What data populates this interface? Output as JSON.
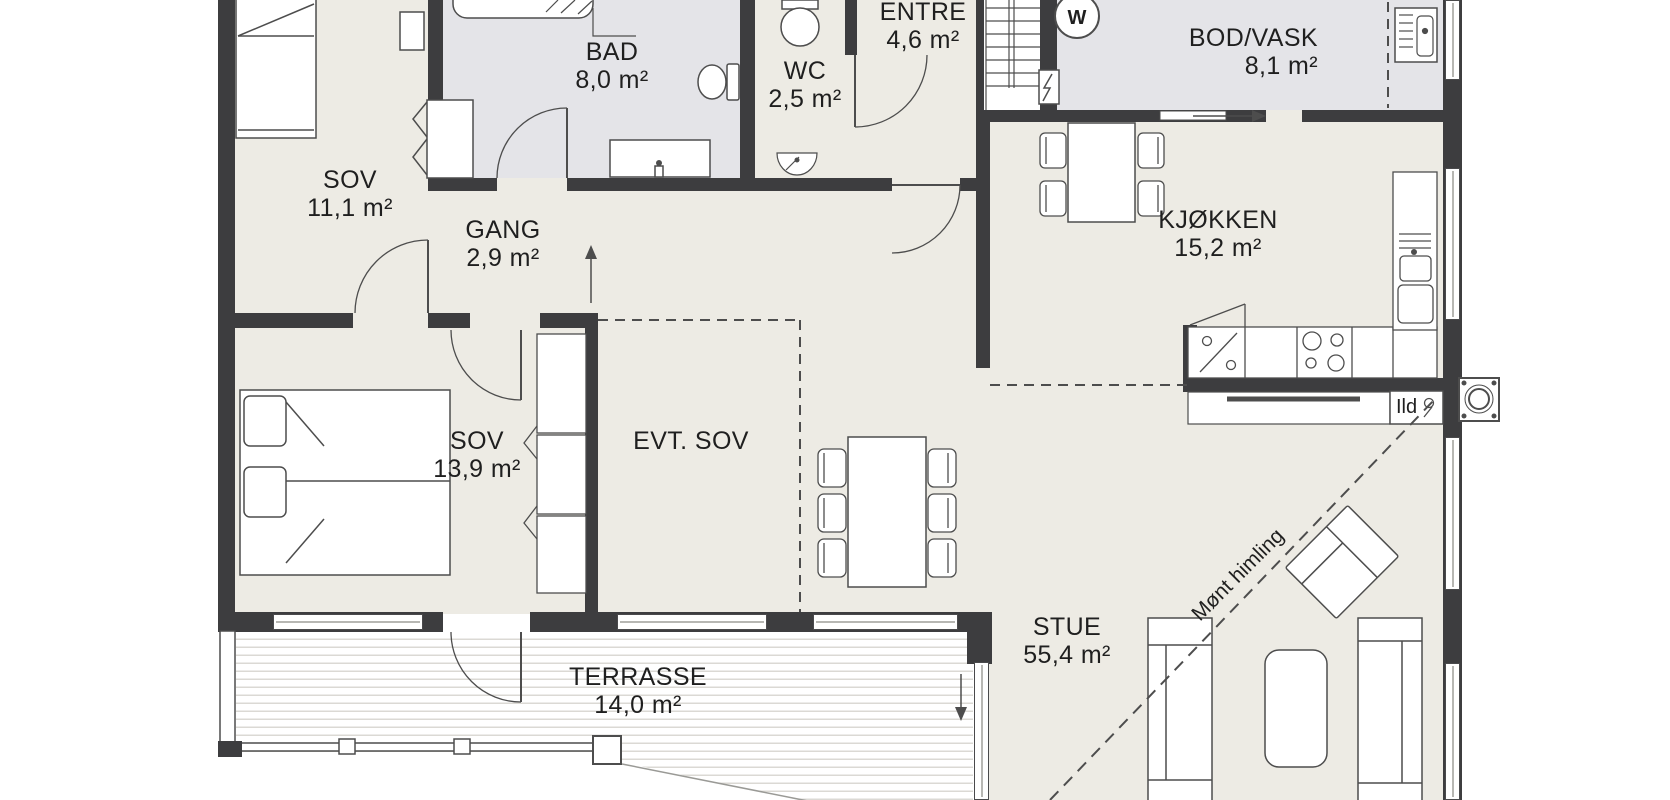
{
  "plan": {
    "type": "floor-plan",
    "rooms": {
      "sov1": {
        "name": "SOV",
        "area": "11,1 m²"
      },
      "bad": {
        "name": "BAD",
        "area": "8,0 m²"
      },
      "wc": {
        "name": "WC",
        "area": "2,5 m²"
      },
      "entre": {
        "name": "ENTRE",
        "area": "4,6 m²"
      },
      "bod": {
        "name": "BOD/VASK",
        "area": "8,1 m²"
      },
      "gang": {
        "name": "GANG",
        "area": "2,9 m²"
      },
      "kjokken": {
        "name": "KJØKKEN",
        "area": "15,2 m²"
      },
      "sov2": {
        "name": "SOV",
        "area": "13,9 m²"
      },
      "evtsov": {
        "name": "EVT. SOV",
        "area": ""
      },
      "stue": {
        "name": "STUE",
        "area": "55,4 m²"
      },
      "terrasse": {
        "name": "TERRASSE",
        "area": "14,0 m²"
      }
    },
    "annotations": {
      "ridge": "Mønt himling",
      "fireplace": "Ild",
      "washer": "W"
    },
    "colors": {
      "wall": "#3d3d3f",
      "floor": "#edebe4",
      "wetroom_floor": "#e4e4e8",
      "line": "#4d4d4d"
    }
  }
}
